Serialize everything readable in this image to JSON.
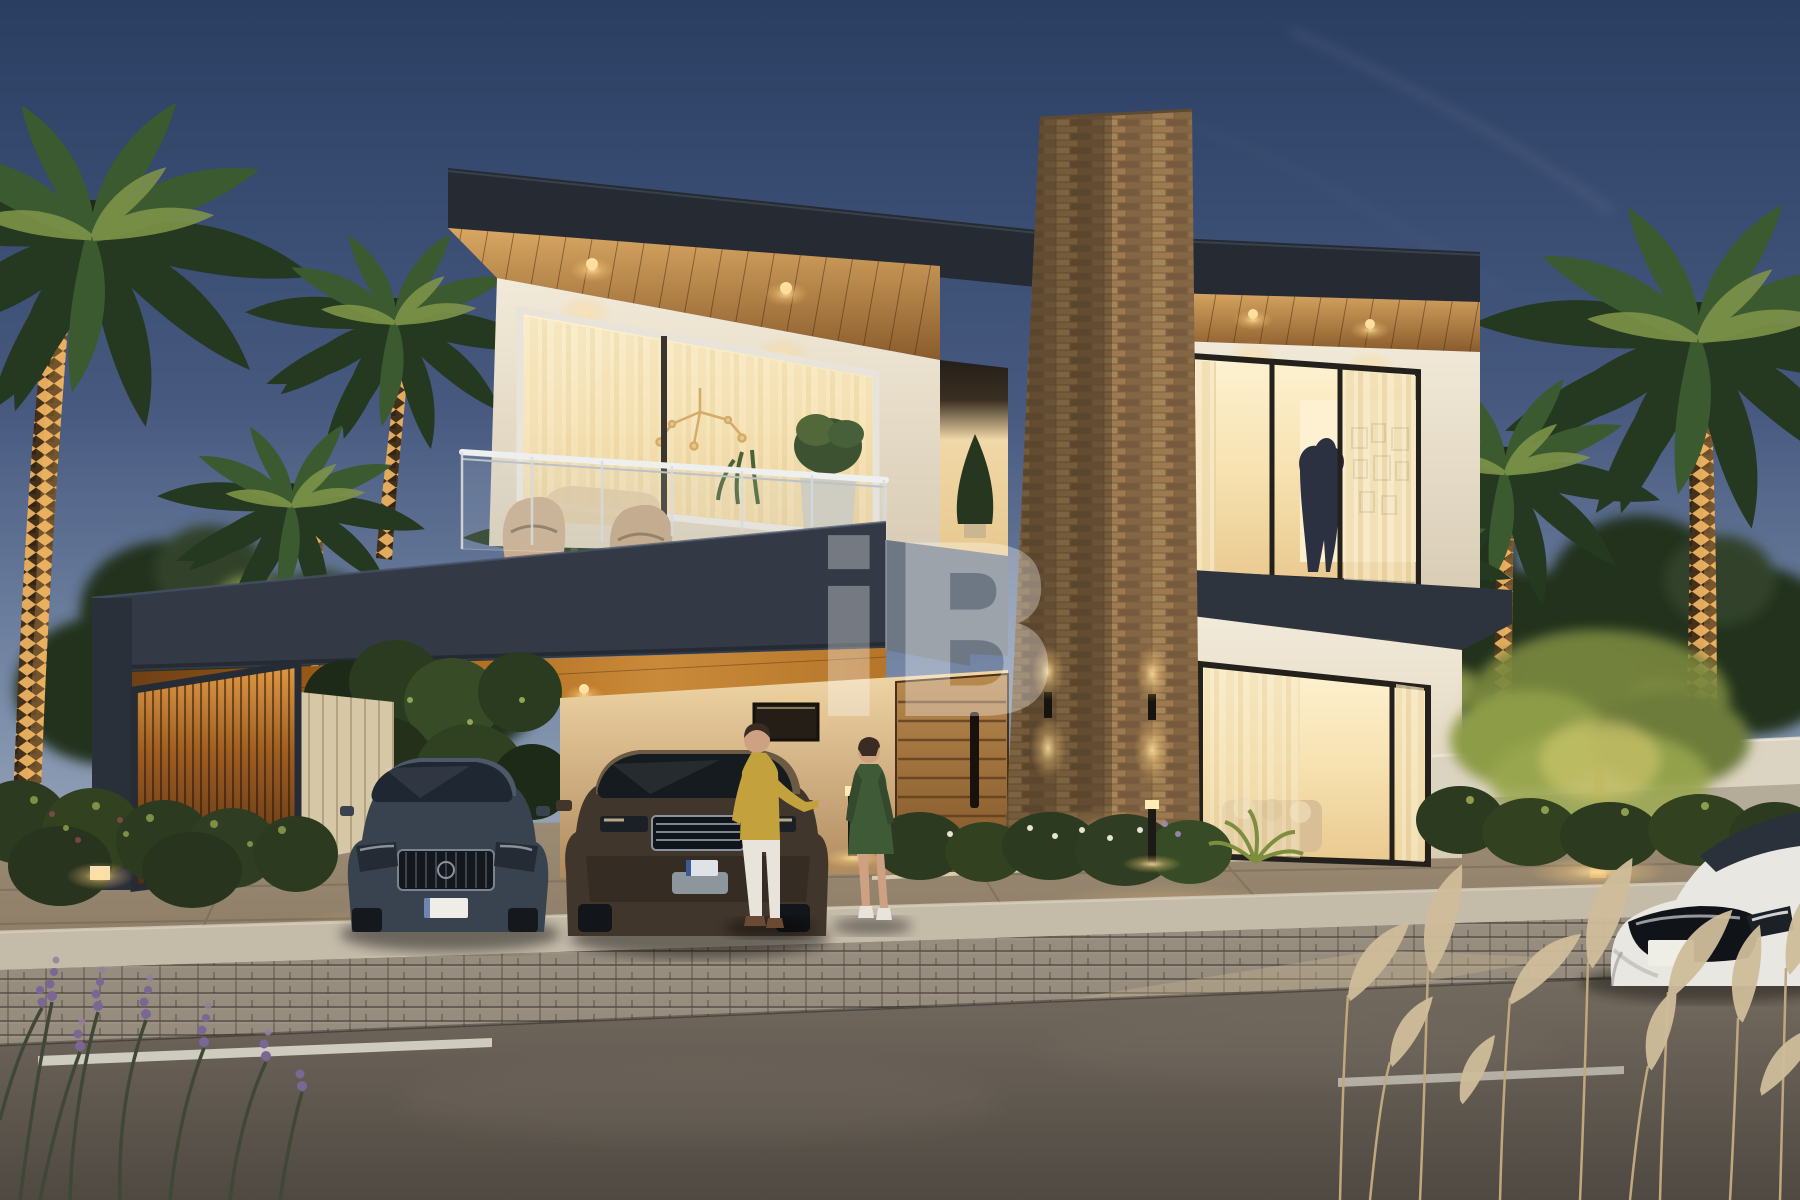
{
  "image": {
    "kind": "architectural-render",
    "time_of_day": "dusk",
    "description": "Photorealistic dusk rendering of a modern two-storey villa with a natural stone feature column, timber-lined carport with two parked SUVs, glass balcony, uplit date palms, landscaped frontage, a couple walking by the entrance and a white sedan at the kerb. Semi-transparent brand watermark in the centre."
  },
  "watermark": {
    "text": "iB"
  },
  "palette": {
    "sky_top": "#2a3e62",
    "sky_mid": "#47597f",
    "sky_low": "#7d8fab",
    "sky_horizon": "#d6d2c6",
    "roof_dark": "#262b33",
    "roof_edge": "#49536a",
    "soffit_hi": "#d8a763",
    "soffit_lo": "#8a5c2c",
    "wall_hi": "#f2ead9",
    "wall_lo": "#d8ccb5",
    "glass_hi": "#fdf2d2",
    "glass_mid": "#f7e2b1",
    "glass_lo": "#e9c98f",
    "frame_dark": "#28251f",
    "stone_mid": "#94714a",
    "stone_hi": "#b98f5d",
    "stone_dark_face": "#7c5f3e",
    "trunk_lit": "#e2ab5e",
    "trunk_dark": "#45301a",
    "frond_dark": "#24391f",
    "frond_mid": "#3c5a2f",
    "frond_lit": "#7d9348",
    "slab_dark": "#333a46",
    "slab_gray": "#6e7884",
    "rail_white": "#eef0f0",
    "ceiling_hi": "#c98a3a",
    "ceiling_lo": "#6e3f16",
    "slat_hi": "#e09a44",
    "slat_lo": "#4f2d11",
    "door_hi": "#b98a50",
    "door_lo": "#7e5426",
    "porch_hi": "#f0d6a6",
    "porch_lo": "#b08a5e",
    "fence": "#d6c7a6",
    "hedge_dark": "#2c3a20",
    "hedge_lit": "#8e9d4c",
    "tree_dark": "#22301c",
    "tree_mid": "#30422a",
    "tree_lit": "#9aa84f",
    "walk": "#c4bba9",
    "cobble": "#978d7f",
    "road_hi": "#756c60",
    "road_lo": "#4f4942",
    "road_line": "#e9e6da",
    "drive_hi": "#9d8d75",
    "drive_lo": "#8a7a64",
    "glow": "#ffd99b",
    "garden_wall": "#dcd4c2",
    "car_dark": "#39424f",
    "car_bronze": "#41362c",
    "car_white": "#e9e7e2",
    "plate": "#efeee6",
    "sweater": "#c3a23d",
    "pants": "#e8e4dc",
    "dress": "#3f5a36",
    "skin": "#cfa183",
    "hair": "#3a2c22",
    "lavender": "#7b6795",
    "pampas": "#cfbd9a",
    "watermark_white": "#ffffff"
  },
  "scene": {
    "setting": "dusk exterior of a modern two-storey villa",
    "objects": [
      {
        "id": "villa",
        "label": "Modern two-storey villa with flat dark roof and warm timber soffits with downlights"
      },
      {
        "id": "stone-column",
        "label": "Full-height natural stone feature column rising above the roofline"
      },
      {
        "id": "balcony",
        "label": "First-floor balcony with glass railing, rattan chairs and planters"
      },
      {
        "id": "carport",
        "label": "Timber-lined carport with vertical slatted wall"
      },
      {
        "id": "front-door",
        "label": "Timber front door with horizontal grooves and vertical pull handle"
      },
      {
        "id": "upper-left-window",
        "label": "Lit upper living room window with chandelier and sheer curtains"
      },
      {
        "id": "upper-right-window",
        "label": "Lit upper window with mother holding a child and gallery picture wall"
      },
      {
        "id": "lower-right-window",
        "label": "Lit ground-floor lounge window with sofa"
      },
      {
        "id": "car-suv-dark",
        "label": "Dark grey estate car parked in carport"
      },
      {
        "id": "car-suv-bronze",
        "label": "Dark bronze SUV parked in carport"
      },
      {
        "id": "car-sedan-white",
        "label": "White sedan at the kerb, partially visible at right edge"
      },
      {
        "id": "man-figure",
        "label": "Man in mustard sweater and white trousers gesturing"
      },
      {
        "id": "woman-figure",
        "label": "Woman in dark green dress walking"
      },
      {
        "id": "palm-trees",
        "label": "Uplit date palms flanking the villa"
      },
      {
        "id": "uplit-tree",
        "label": "Uplit garden tree behind a white boundary wall"
      },
      {
        "id": "hedges",
        "label": "Low hedges and flowering shrubs along the frontage"
      },
      {
        "id": "bollard-lights",
        "label": "Warm bollard and wall path lights"
      },
      {
        "id": "road",
        "label": "Asphalt street with dashed white centre line, cobbled verge and light kerb"
      },
      {
        "id": "lavender",
        "label": "Purple lavender stems in the near foreground"
      },
      {
        "id": "pampas-grass",
        "label": "Dry pampas grass plumes in the near foreground"
      },
      {
        "id": "sky",
        "label": "Clear dusk sky with a faint contrail"
      }
    ],
    "counts": {
      "lane_dashes": 2,
      "parked_cars": 3,
      "people_outside": 2,
      "figures_in_window": 2
    }
  }
}
